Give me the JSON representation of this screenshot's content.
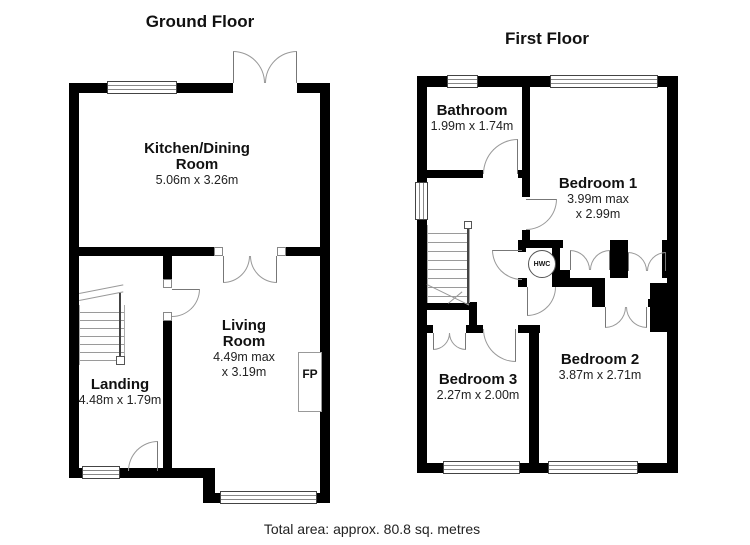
{
  "ground_floor": {
    "title": "Ground Floor",
    "kitchen_dining": {
      "name_line1": "Kitchen/Dining",
      "name_line2": "Room",
      "dims": "5.06m x 3.26m"
    },
    "living_room": {
      "name_line1": "Living",
      "name_line2": "Room",
      "dims_line1": "4.49m max",
      "dims_line2": "x 3.19m"
    },
    "landing": {
      "name": "Landing",
      "dims": "4.48m x 1.79m"
    },
    "fireplace_label": "FP"
  },
  "first_floor": {
    "title": "First Floor",
    "bathroom": {
      "name": "Bathroom",
      "dims": "1.99m x 1.74m"
    },
    "bedroom1": {
      "name": "Bedroom 1",
      "dims_line1": "3.99m max",
      "dims_line2": "x 2.99m"
    },
    "bedroom2": {
      "name": "Bedroom 2",
      "dims": "3.87m x 2.71m"
    },
    "bedroom3": {
      "name": "Bedroom 3",
      "dims": "2.27m x 2.00m"
    },
    "hot_water_cylinder_label": "HWC"
  },
  "footer": {
    "total_area": "Total area: approx. 80.8 sq. metres"
  },
  "colors": {
    "wall": "#000000",
    "background": "#ffffff",
    "door_arc": "#9a9a9a",
    "text": "#1a1a1a"
  }
}
